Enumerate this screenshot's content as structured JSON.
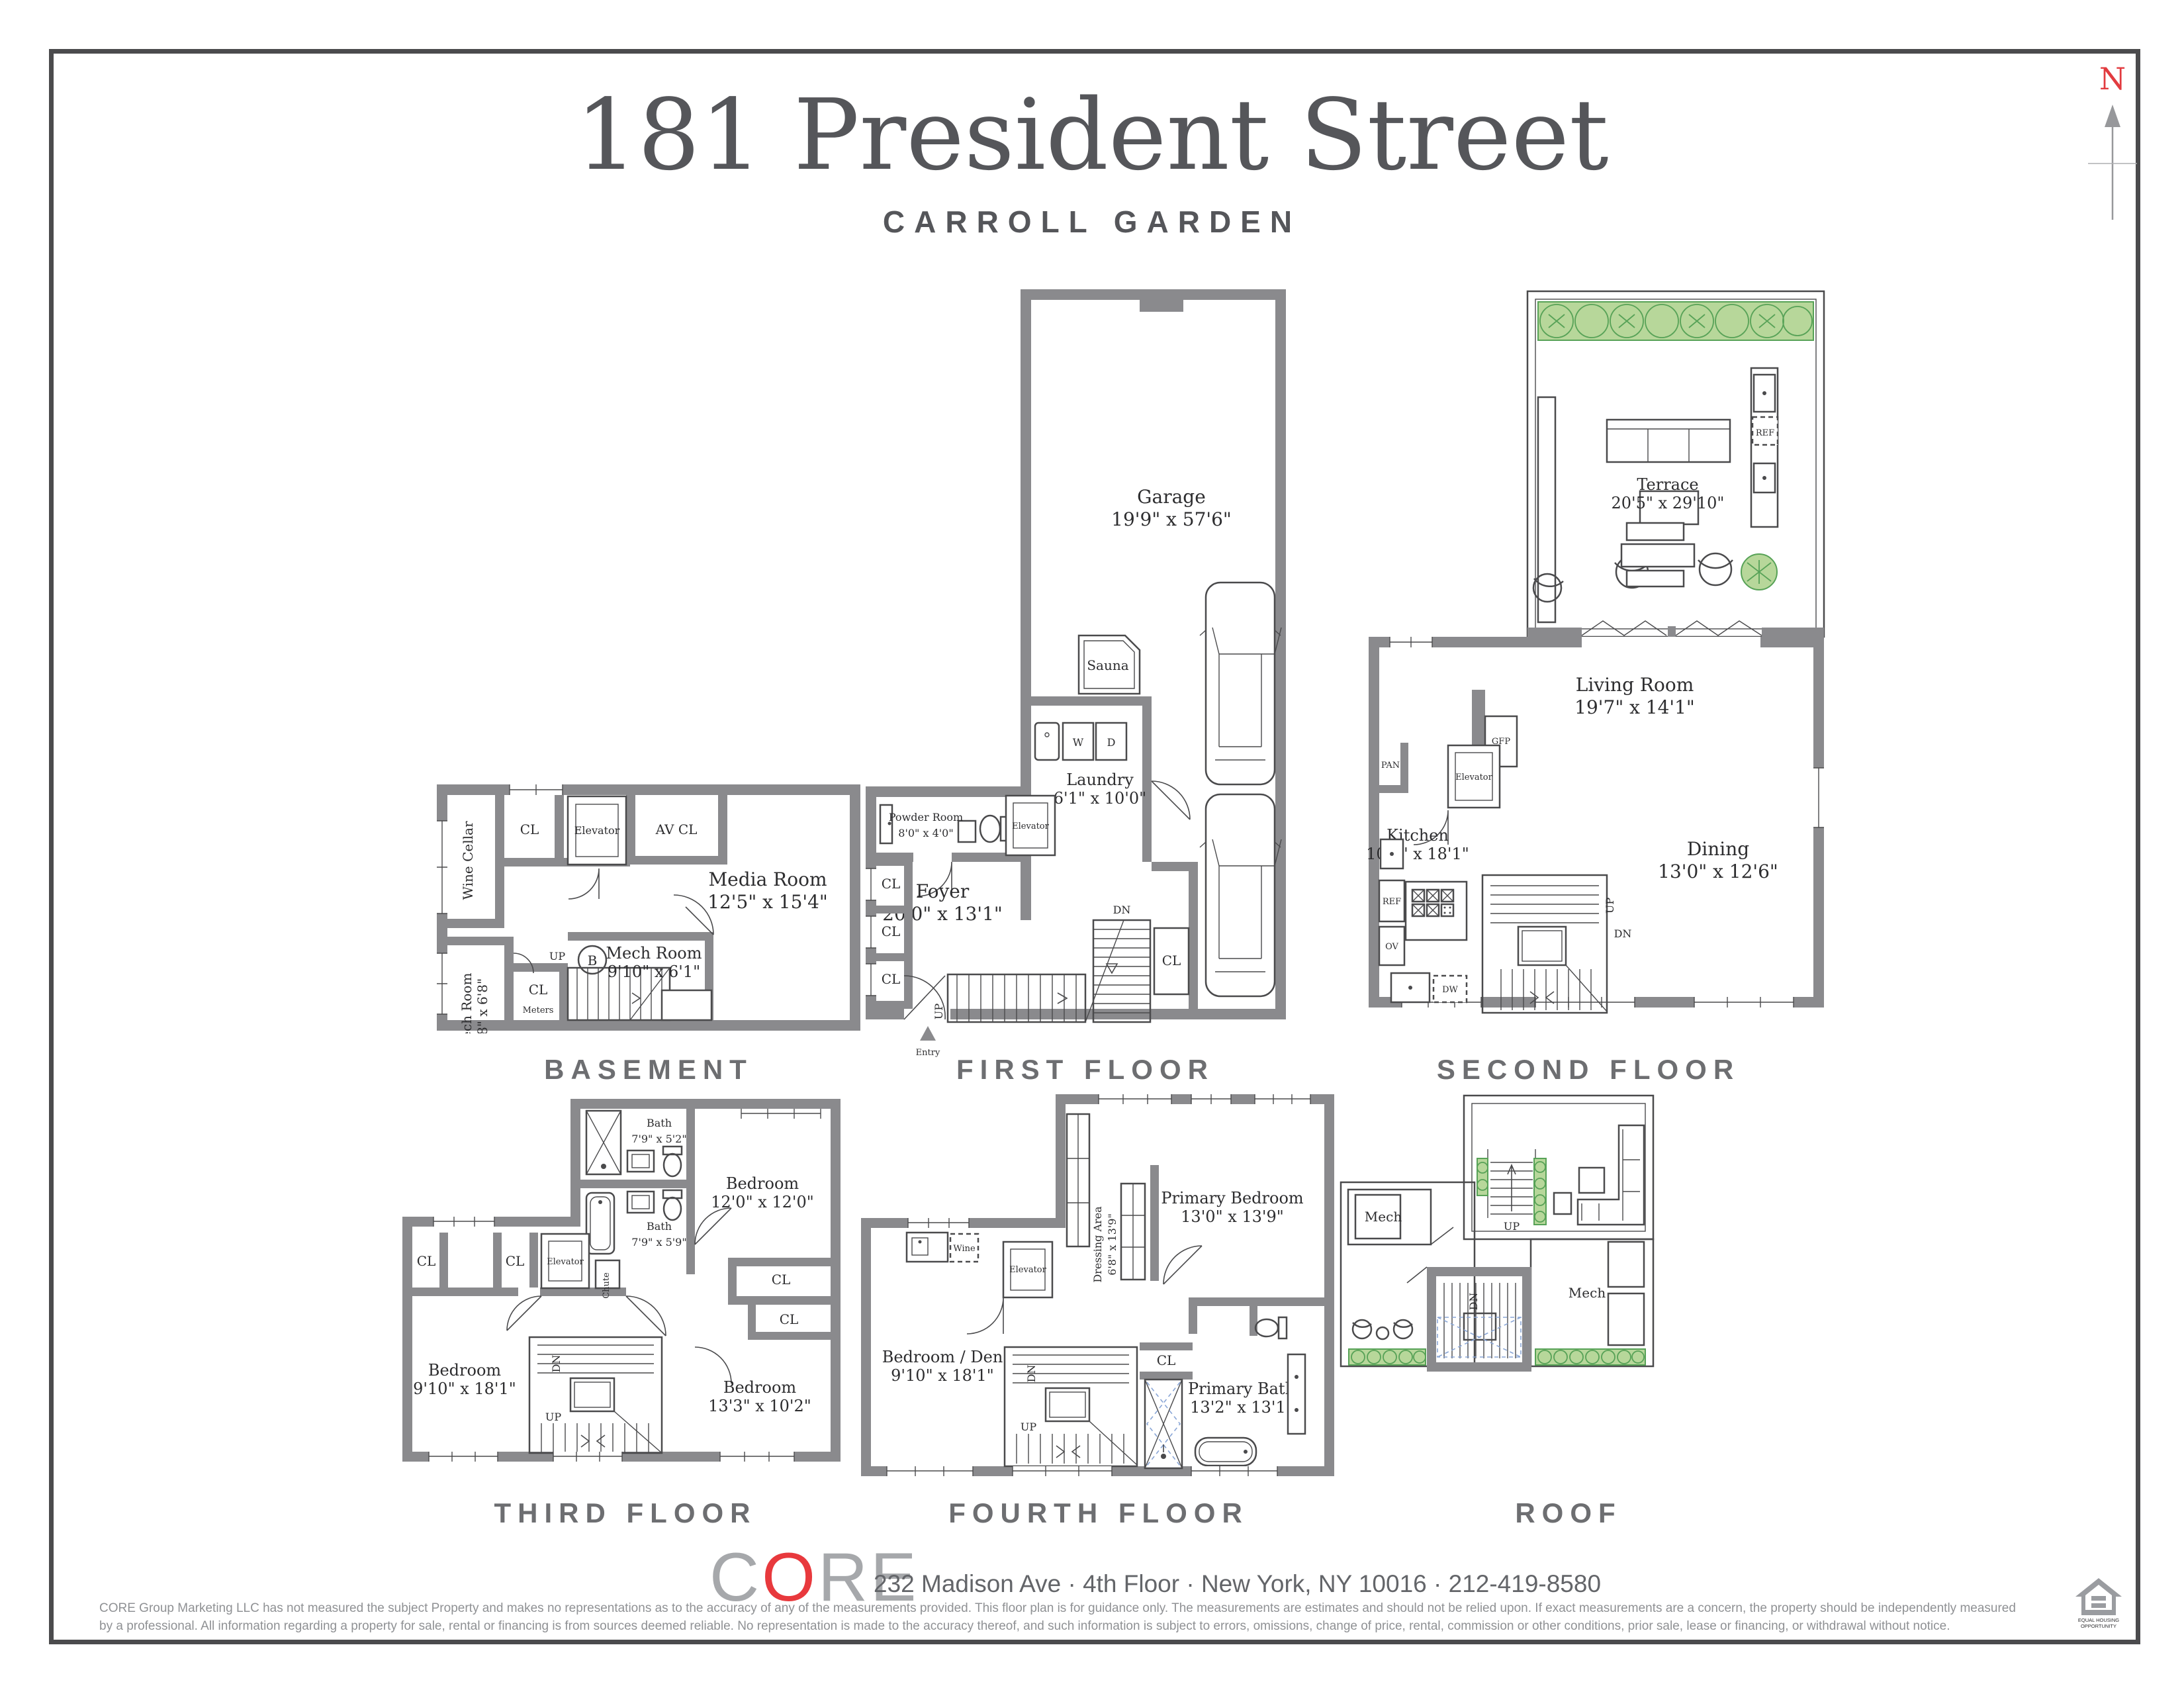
{
  "header": {
    "title": "181 President Street",
    "subtitle": "CARROLL GARDEN",
    "compass_n": "N"
  },
  "floors": {
    "basement": {
      "label": "BASEMENT",
      "wine_cellar": "Wine Cellar",
      "cl": "CL",
      "elevator": "Elevator",
      "av_cl": "AV CL",
      "media_room": "Media Room",
      "media_room_dims": "12'5\" x 15'4\"",
      "mech_small": "Mech Room",
      "mech_small_dims": "4'8\" x 6'8\"",
      "meters": "Meters",
      "up": "UP",
      "b": "B",
      "mech": "Mech Room",
      "mech_dims": "9'10\" x 6'1\""
    },
    "first": {
      "label": "FIRST FLOOR",
      "garage": "Garage",
      "garage_dims": "19'9\" x 57'6\"",
      "sauna": "Sauna",
      "w": "W",
      "d": "D",
      "laundry": "Laundry",
      "laundry_dims": "6'1\" x 10'0\"",
      "powder": "Powder Room",
      "powder_dims": "8'0\" x 4'0\"",
      "elevator": "Elevator",
      "foyer": "Foyer",
      "foyer_dims": "20'0\" x 13'1\"",
      "cl": "CL",
      "up": "UP",
      "dn": "DN",
      "entry": "Entry"
    },
    "second": {
      "label": "SECOND FLOOR",
      "terrace": "Terrace",
      "terrace_dims": "20'5\" x 29'10\"",
      "ref": "REF",
      "gfp": "GFP",
      "living": "Living Room",
      "living_dims": "19'7\" x 14'1\"",
      "pan": "PAN",
      "elevator": "Elevator",
      "kitchen": "Kitchen",
      "kitchen_dims": "10'2\" x 18'1\"",
      "ov": "OV",
      "dw": "DW",
      "up": "UP",
      "dn": "DN",
      "dining": "Dining",
      "dining_dims": "13'0\" x 12'6\""
    },
    "third": {
      "label": "THIRD FLOOR",
      "bath1": "Bath",
      "bath1_dims": "7'9\" x 5'2\"",
      "bedroom1": "Bedroom",
      "bedroom1_dims": "12'0\" x 12'0\"",
      "bath2": "Bath",
      "bath2_dims": "7'9\" x 5'9\"",
      "cl": "CL",
      "elevator": "Elevator",
      "chute": "Chute",
      "bedroom2": "Bedroom",
      "bedroom2_dims": "9'10\" x 18'1\"",
      "up": "UP",
      "dn": "DN",
      "bedroom3": "Bedroom",
      "bedroom3_dims": "13'3\" x 10'2\""
    },
    "fourth": {
      "label": "FOURTH FLOOR",
      "dressing": "Dressing Area",
      "dressing_dims": "6'8\" x 13'9\"",
      "primary_bedroom": "Primary Bedroom",
      "primary_bedroom_dims": "13'0\" x 13'9\"",
      "wine": "Wine",
      "elevator": "Elevator",
      "bedroom_den": "Bedroom / Den",
      "bedroom_den_dims": "9'10\" x 18'1\"",
      "cl": "CL",
      "up": "UP",
      "dn": "DN",
      "primary_bath": "Primary Bath",
      "primary_bath_dims": "13'2\" x 13'1\""
    },
    "roof": {
      "label": "ROOF",
      "mech_left": "Mech",
      "mech_right": "Mech",
      "up": "UP",
      "dn": "DN"
    }
  },
  "footer": {
    "logo_c": "C",
    "logo_o": "O",
    "logo_re": "RE",
    "address": "232 Madison Ave · 4th Floor · New York, NY 10016 · 212-419-8580",
    "disclaimer1": "CORE Group Marketing LLC has not measured the subject Property and makes no representations as to the accuracy of any of the measurements provided. This floor plan is for guidance only. The measurements are estimates and should not be relied upon. If exact measurements are a concern, the property should be independently measured",
    "disclaimer2": "by a professional. All information regarding a property for sale, rental or financing is from sources deemed reliable.  No representation is made to the accuracy thereof, and such information is subject to errors, omissions, change of price, rental, commission or other conditions, prior sale, lease or financing, or withdrawal without notice.",
    "eho1": "EQUAL HOUSING",
    "eho2": "OPPORTUNITY"
  },
  "colors": {
    "wall": "#8a8a8d",
    "accent_red": "#e23b3f",
    "green_fill": "#b7d79a",
    "green_stroke": "#57a257",
    "floor_label": "#6d6e71",
    "ink": "#4a4a4c",
    "blue_dash": "#8aa6d6"
  }
}
